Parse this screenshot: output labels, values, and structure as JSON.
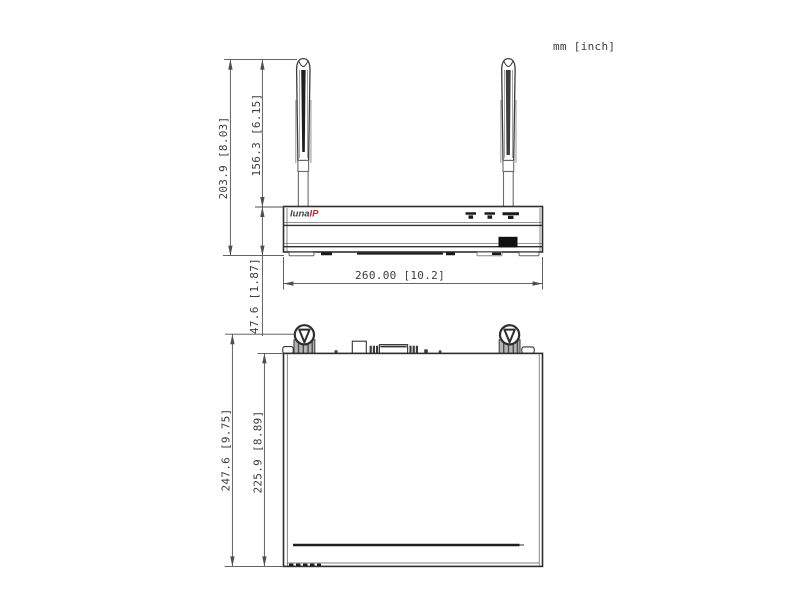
{
  "units_label": "mm [inch]",
  "logo": {
    "luna": "luna",
    "ip": "IP"
  },
  "views": {
    "front": {
      "dims": {
        "overall_height": "203.9 [8.03]",
        "antenna_height": "156.3 [6.15]",
        "body_height": "47.6 [1.87]",
        "width": "260.00 [10.2]"
      }
    },
    "top": {
      "dims": {
        "overall_depth": "247.6 [9.75]",
        "body_depth": "225.9 [8.89]"
      }
    }
  },
  "colors": {
    "line": "#333333",
    "dim_line": "#4f4f4f",
    "logo_dark": "#3f3f3f",
    "logo_red": "#c1272d",
    "gray_light": "#b3b3b3"
  }
}
